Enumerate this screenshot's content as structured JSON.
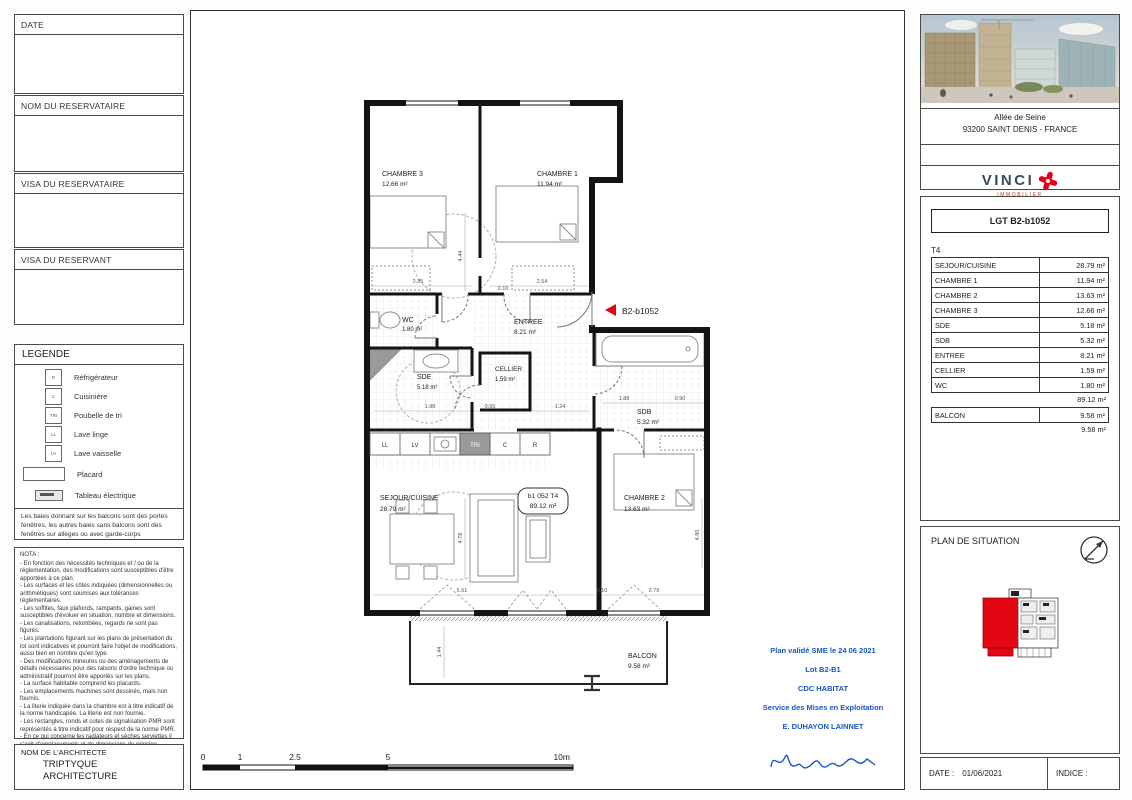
{
  "left": {
    "boxes": [
      "DATE",
      "NOM DU RESERVATAIRE",
      "VISA DU RESERVATAIRE",
      "VISA DU RESERVANT"
    ],
    "legend": {
      "title": "LEGENDE",
      "items": [
        {
          "sym": "R",
          "label": "Réfrigérateur"
        },
        {
          "sym": "C",
          "label": "Cuisinière"
        },
        {
          "sym": "TRI",
          "label": "Poubelle de tri"
        },
        {
          "sym": "LL",
          "label": "Lave linge"
        },
        {
          "sym": "LV",
          "label": "Lave vaisselle"
        },
        {
          "sym": "",
          "label": "Placard"
        },
        {
          "sym": "",
          "label": "Tableau électrique"
        }
      ],
      "note": "Les baies donnant sur les balcons sont des portes fenêtres, les autres baies sans balcons sont des fenêtres sur allèges ou avec garde-corps"
    },
    "nota_title": "NOTA :",
    "nota": "- En fonction des nécessités techniques et / ou de la réglementation, des modifications sont susceptibles d'être apportées à ce plan.\n- Les surfaces et les côtes indiquées (dimensionnelles ou arithmétiques) sont soumises aux tolérances réglementaires.\n- Les soffites, faux plafonds, rampants, gaines sont susceptibles d'évoluer en situation, nombre et dimensions.\n- Les canalisations, retombées, regards ne sont pas figurés.\n- Les plantations figurant sur les plans de présentation du lot sont indicatives et pourront faire l'objet de modifications, aussi bien en nombre qu'en type.\n- Des modifications mineures ou des aménagements de détails nécessaires pour des raisons d'ordre technique ou administratif pourront être apportés sur les plans.\n- La surface habitable comprend les placards.\n- Les emplacements machines sont dessinés, mais non fournis.\n- La literie indiquée dans la chambre est à titre indicatif de la norme handicapée. La literie est non fournie.\n- Les rectangles, ronds et cotes de signalisation PMR sont représentés à titre indicatif pour respect de la norme PMR.\n- En ce qui concerne les radiateurs et sèches serviettes il s'agit d'emplacements et de dimensions de principe",
    "architect_label": "NOM DE L'ARCHITECTE",
    "architect_name": "TRIPTYQUE\nARCHITECTURE"
  },
  "plan": {
    "marker": "B2-b1052",
    "stamp_line1": "b1 052 T4",
    "stamp_line2": "89.12 m²",
    "rooms": {
      "chambre3": {
        "name": "CHAMBRE 3",
        "area": "12.66 m²"
      },
      "chambre1": {
        "name": "CHAMBRE 1",
        "area": "11.94 m²"
      },
      "wc": {
        "name": "WC",
        "area": "1.80 m²"
      },
      "entree": {
        "name": "ENTREE",
        "area": "8.21 m²"
      },
      "sde": {
        "name": "SDE",
        "area": "5.18 m²"
      },
      "cellier": {
        "name": "CELLIER",
        "area": "1.59 m²"
      },
      "sdb": {
        "name": "SDB",
        "area": "5.32 m²"
      },
      "sejour": {
        "name": "SEJOUR/CUISINE",
        "area": "28.79 m²"
      },
      "chambre2": {
        "name": "CHAMBRE 2",
        "area": "13.63 m²"
      },
      "balcon": {
        "name": "BALCON",
        "area": "9.58 m²"
      }
    },
    "kitchen": [
      "LL",
      "LV",
      "TRI",
      "C",
      "R"
    ],
    "dims": [
      "2.85",
      "2.54",
      "4.44",
      "0.10",
      "1.98",
      "0.55",
      "1.24",
      "1.88",
      "0.90",
      "5.61",
      "4.78",
      "2.79",
      "4.80",
      "1.44",
      "0.10"
    ]
  },
  "scale": {
    "ticks": [
      "0",
      "1",
      "2.5",
      "5",
      "10m"
    ]
  },
  "validation": {
    "l1": "Plan validé SME le 24 06 2021",
    "l2": "Lot B2-B1",
    "l3": "CDC HABITAT",
    "l4": "Service des Mises en Exploitation",
    "l5": "E. DUHAYON LAINNET"
  },
  "right": {
    "address1": "Allée de Seine",
    "address2": "93200 SAINT DENIS - FRANCE",
    "brand": "VINCI",
    "brand_sub": "IMMOBILIER",
    "table": {
      "title": "LGT B2-b1052",
      "type": "T4",
      "rows": [
        [
          "SEJOUR/CUISINE",
          "28.79 m²"
        ],
        [
          "CHAMBRE 1",
          "11.94 m²"
        ],
        [
          "CHAMBRE 2",
          "13.63 m²"
        ],
        [
          "CHAMBRE 3",
          "12.66 m²"
        ],
        [
          "SDE",
          "5.18 m²"
        ],
        [
          "SDB",
          "5.32 m²"
        ],
        [
          "ENTREE",
          "8.21 m²"
        ],
        [
          "CELLIER",
          "1.59 m²"
        ],
        [
          "WC",
          "1.80 m²"
        ]
      ],
      "total": "89.12 m²",
      "balcon_label": "BALCON",
      "balcon_area": "9.58 m²",
      "balcon_total": "9.58 m²"
    },
    "situation_title": "PLAN DE SITUATION",
    "date_label": "DATE :",
    "date_value": "01/06/2021",
    "indice_label": "INDICE :"
  },
  "colors": {
    "red": "#e30613",
    "blue": "#1a56c4"
  }
}
